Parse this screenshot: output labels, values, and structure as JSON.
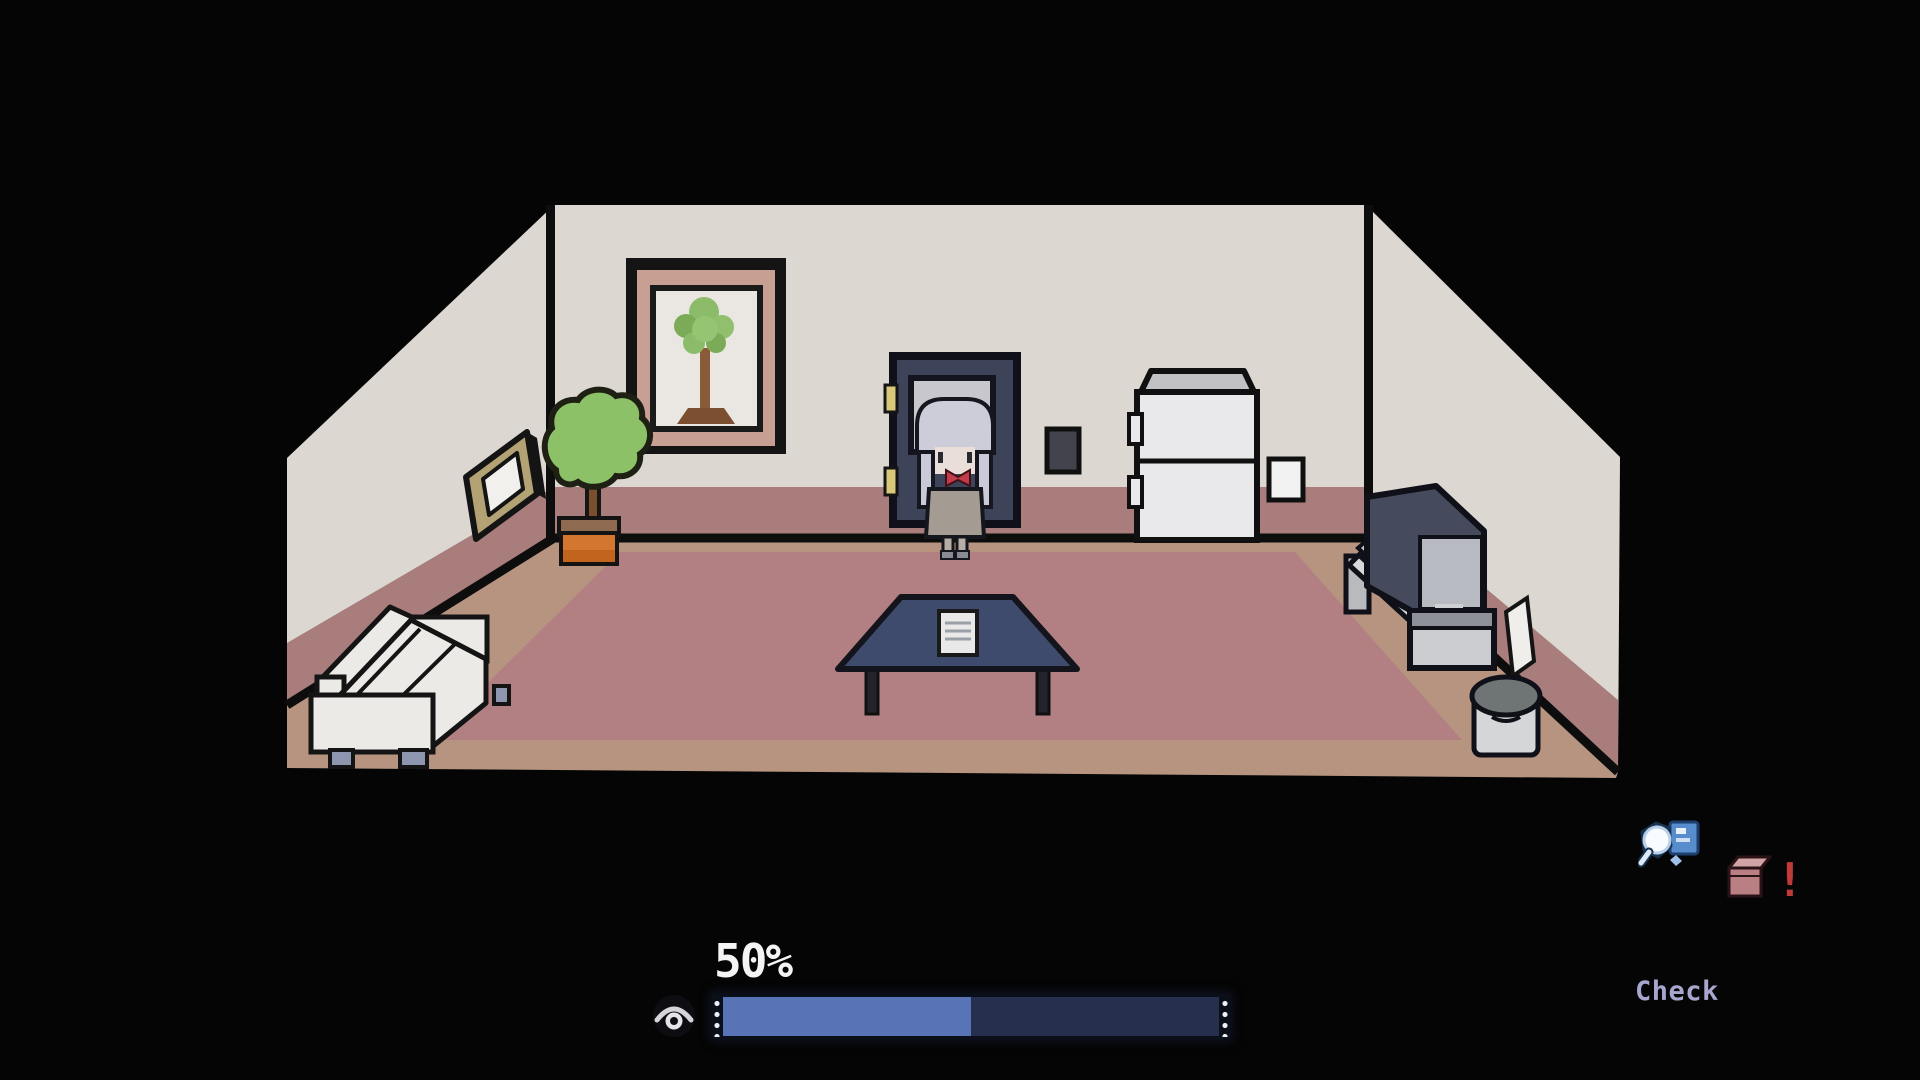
{
  "hud": {
    "progress_label": "50%",
    "progress_percent": 50,
    "action_label": "Check",
    "item_alert": "!"
  },
  "colors": {
    "background": "#050505",
    "wall": "#dcd7d1",
    "wall_band": "#a87d7c",
    "floor": "#b6947f",
    "rug": "#b28082",
    "outline": "#0d0d0d",
    "door": "#3d4459",
    "table": "#3f4b6c",
    "couch": "#eceae7",
    "plant_green": "#8cc167",
    "pot_orange": "#d3762f",
    "progress_fill": "#5973b7",
    "progress_track": "#272f4f",
    "progress_text": "#f4f4f4",
    "check_text": "#a6a6cf",
    "alert_red": "#c13a3a"
  },
  "scene": {
    "room": "living-room",
    "objects": [
      "rug",
      "tree-painting",
      "wall-frame",
      "potted-plant",
      "door",
      "character",
      "light-switch",
      "refrigerator",
      "wall-panel",
      "tv",
      "tv-stand",
      "wall-paper",
      "trash-can",
      "low-table",
      "table-paper",
      "couch"
    ]
  }
}
